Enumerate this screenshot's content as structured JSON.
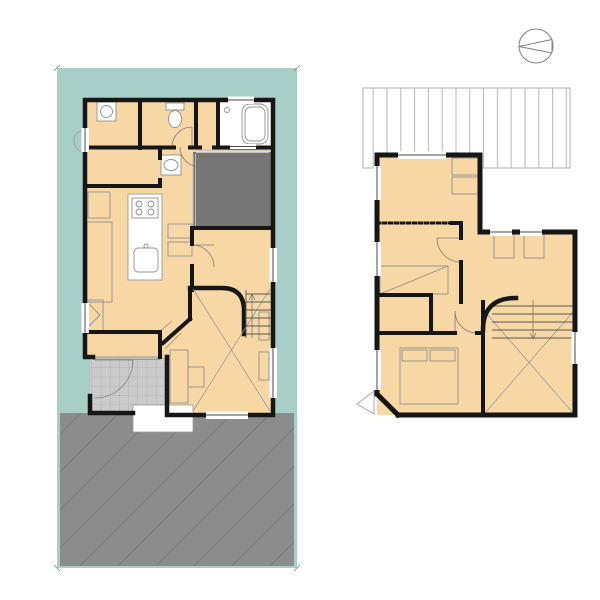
{
  "colors": {
    "site_teal": "#a7cec7",
    "room_peach": "#f7d8a4",
    "terrace_gray": "#757575",
    "parking_gray": "#8c8c8c",
    "tile_gray": "#cbcbcb",
    "wall_black": "#161616"
  },
  "compass": {
    "north": "N"
  },
  "floor1": {
    "label": "1F",
    "boundaries": {
      "top": {
        "value": "8692",
        "name": "隣地境界線"
      },
      "left": {
        "value": "17715",
        "name": "隣地境界線"
      },
      "right": {
        "value": "17722",
        "name": "隣地境界線"
      },
      "bottom": {
        "value": "8691",
        "name": "道路境界線"
      }
    },
    "rooms": {
      "laundry1": "ランドリー",
      "laundry2": "ルーム",
      "laundry_size": "2",
      "toilet": "トイレ",
      "dressing": "脱衣室",
      "bath": "浴室",
      "wic": "WIC",
      "wic_size": "1.5",
      "washroom": "洗面",
      "terrace": "テラス",
      "fridge": "冷",
      "cupboard": "カップボード",
      "dk": "DK",
      "dk_size": "10.7",
      "pit1": "ピット",
      "pit2": "スペース",
      "pit_size": "4.7",
      "nook": "ヌック",
      "storage": "収納",
      "entrance": "玄関",
      "entrance_closet": "EC",
      "up": "UP",
      "living": "リビング",
      "living_size": "7",
      "planting": "植栽",
      "parking": "駐車スペース"
    }
  },
  "floor2": {
    "label": "2F",
    "rooms": {
      "western1": "洋室",
      "western1_size": "5.2",
      "western2": "洋室",
      "western2_size": "4.5",
      "hall": "ホール",
      "study1": "スタディ",
      "study2": "スペース",
      "study_size": "6.1",
      "dn": "DN",
      "wic": "WIC",
      "bedroom": "寝室",
      "bedroom_size": "7.5",
      "void": "吹抜"
    }
  },
  "areas": {
    "rows": [
      {
        "main": "1F床面積/60.72㎡",
        "tsubo": "（18.36坪）"
      },
      {
        "main": "2F床面積/43.32㎡",
        "tsubo": "（13.10坪）"
      },
      {
        "main": "延床面積/104.04㎡",
        "tsubo": "（31.46坪）"
      },
      {
        "main": "敷地面積/154.01㎡",
        "tsubo": "(46.58坪）"
      }
    ]
  }
}
